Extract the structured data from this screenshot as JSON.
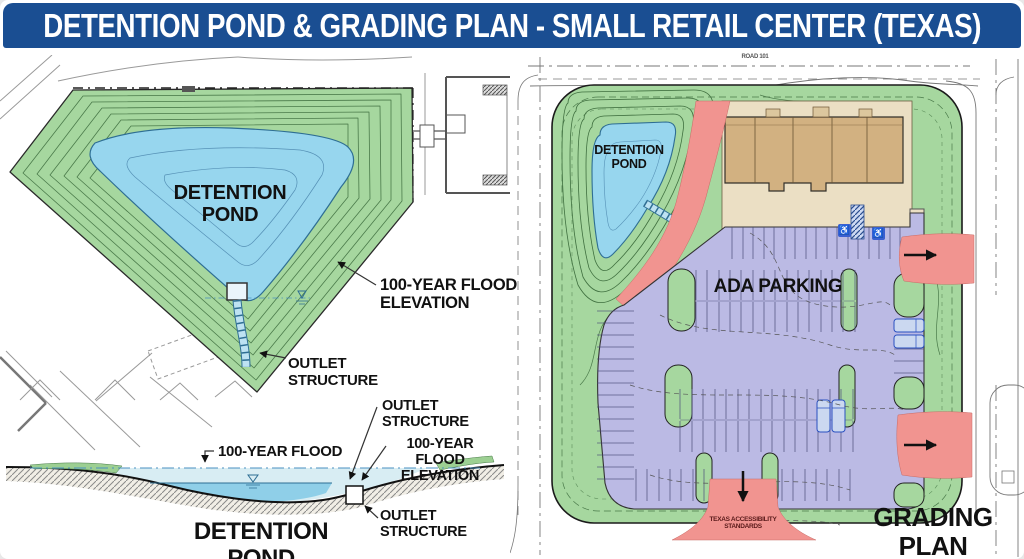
{
  "title": "DETENTION POND & GRADING PLAN - SMALL RETAIL CENTER (TEXAS)",
  "pond_plan": {
    "pond_label": "DETENTION\nPOND",
    "flood_elevation_label": "100-YEAR FLOOD\nELEVATION",
    "outlet_structure_label": "OUTLET\nSTRUCTURE"
  },
  "cross_section": {
    "flood_label": "100-YEAR FLOOD",
    "outlet_structure_label_top": "OUTLET\nSTRUCTURE",
    "flood_elevation_label": "100-YEAR FLOOD\nELEVATION",
    "outlet_structure_label_bottom": "OUTLET\nSTRUCTURE",
    "caption": "DETENTION POND"
  },
  "grading_plan": {
    "road_label": "ROAD 101",
    "pond_label": "DETENTION\nPOND",
    "ada_parking_label": "ADA PARKING",
    "accessibility_note": "TEXAS ACCESSIBILITY\nSTANDARDS",
    "caption": "GRADING PLAN"
  },
  "icons": {
    "wheelchair": "♿"
  },
  "colors": {
    "title_bg": "#1A4E92",
    "title_text": "#FFFFFF",
    "landscape_green": "#A6D79F",
    "pond_blue": "#97D6EE",
    "parking_lavender": "#BBBAE4",
    "accent_red": "#F19490",
    "building_tan": "#D2B181",
    "sidewalk_tan": "#EBDFC4",
    "label_black": "#111111"
  }
}
